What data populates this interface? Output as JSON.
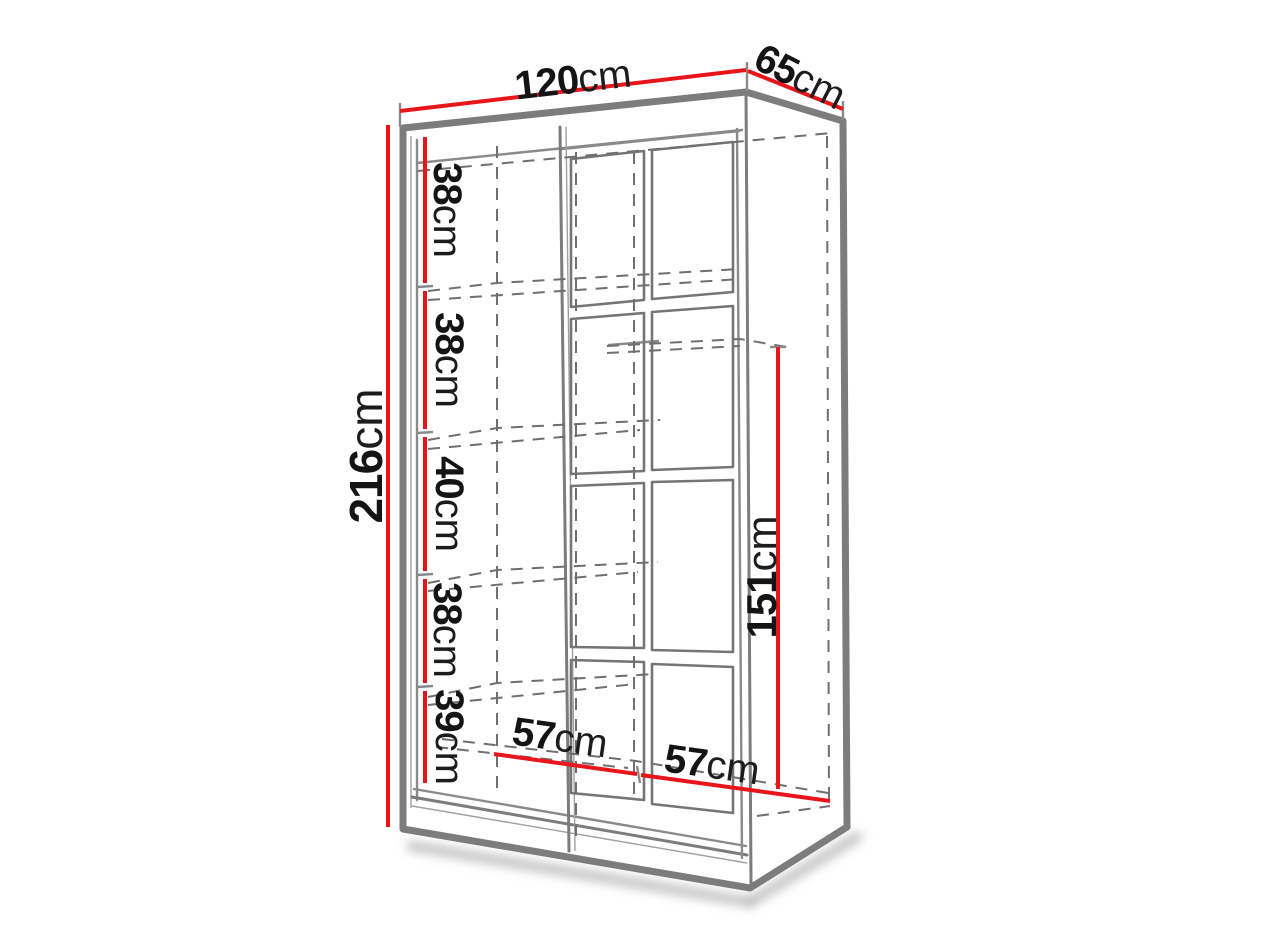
{
  "labels": {
    "unit": "cm",
    "width_value": "120",
    "depth_value": "65",
    "height_value": "216",
    "inner_height_value": "151",
    "shelf_gap_values": [
      "38",
      "38",
      "40",
      "38",
      "39"
    ],
    "compartment_width_values": [
      "57",
      "57"
    ]
  },
  "colors": {
    "dimension_line_red": "#e8151b",
    "drawing_line_gray": "#7c7c7c",
    "label_text": "#141414",
    "background": "#ffffff"
  }
}
